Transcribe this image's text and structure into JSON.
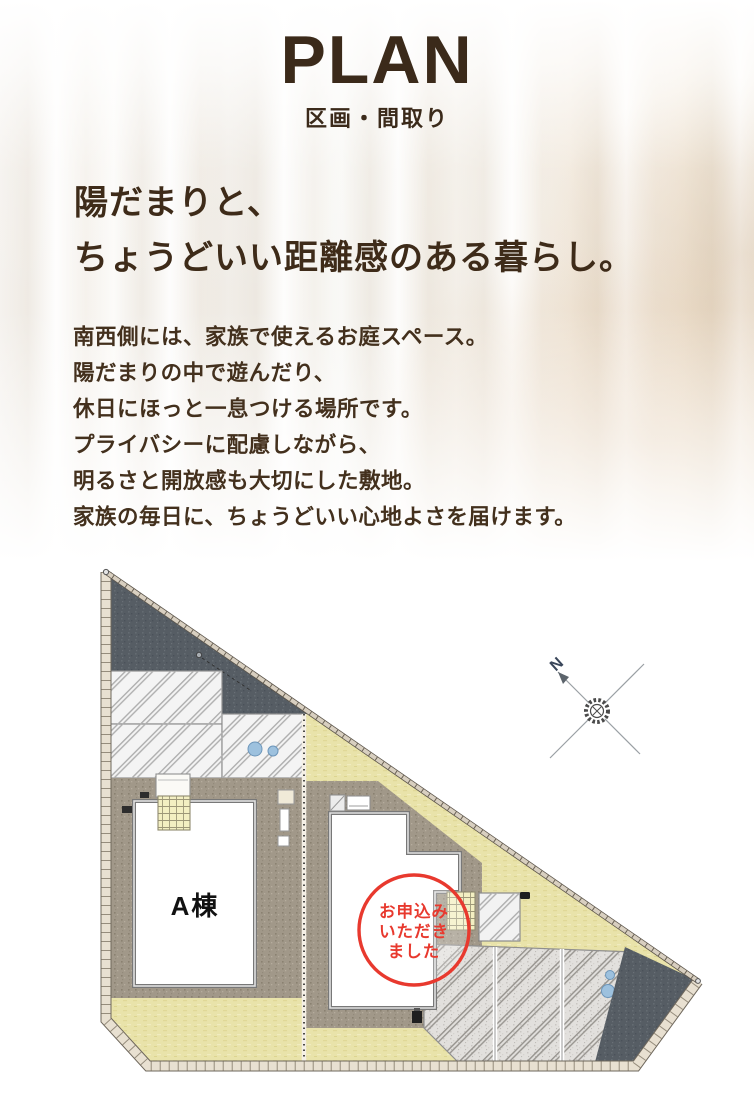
{
  "header": {
    "title": "PLAN",
    "subtitle": "区画・間取り"
  },
  "intro": {
    "heading_lines": [
      "陽だまりと、",
      "ちょうどいい距離感のある暮らし。"
    ],
    "body_lines": [
      "南西側には、家族で使えるお庭スペース。",
      "陽だまりの中で遊んだり、",
      "休日にほっと一息つける場所です。",
      "プライバシーに配慮しながら、",
      "明るさと開放感も大切にした敷地。",
      "家族の毎日に、ちょうどいい心地よさを届けます。"
    ]
  },
  "site_plan": {
    "building_a_label": "A棟",
    "sold_stamp_lines": [
      "お申込み",
      "いただき",
      "ました"
    ],
    "compass_label": "N",
    "colors": {
      "text_brown": "#3b2a1a",
      "stamp_red": "#e8392e",
      "roof_dark": "#565d64",
      "gravel": "#a19889",
      "lawn": "#e9e3aa",
      "tile": "#f3efc2",
      "wall_border": "#e8e0d1",
      "water_blue": "#9dc1de"
    }
  }
}
